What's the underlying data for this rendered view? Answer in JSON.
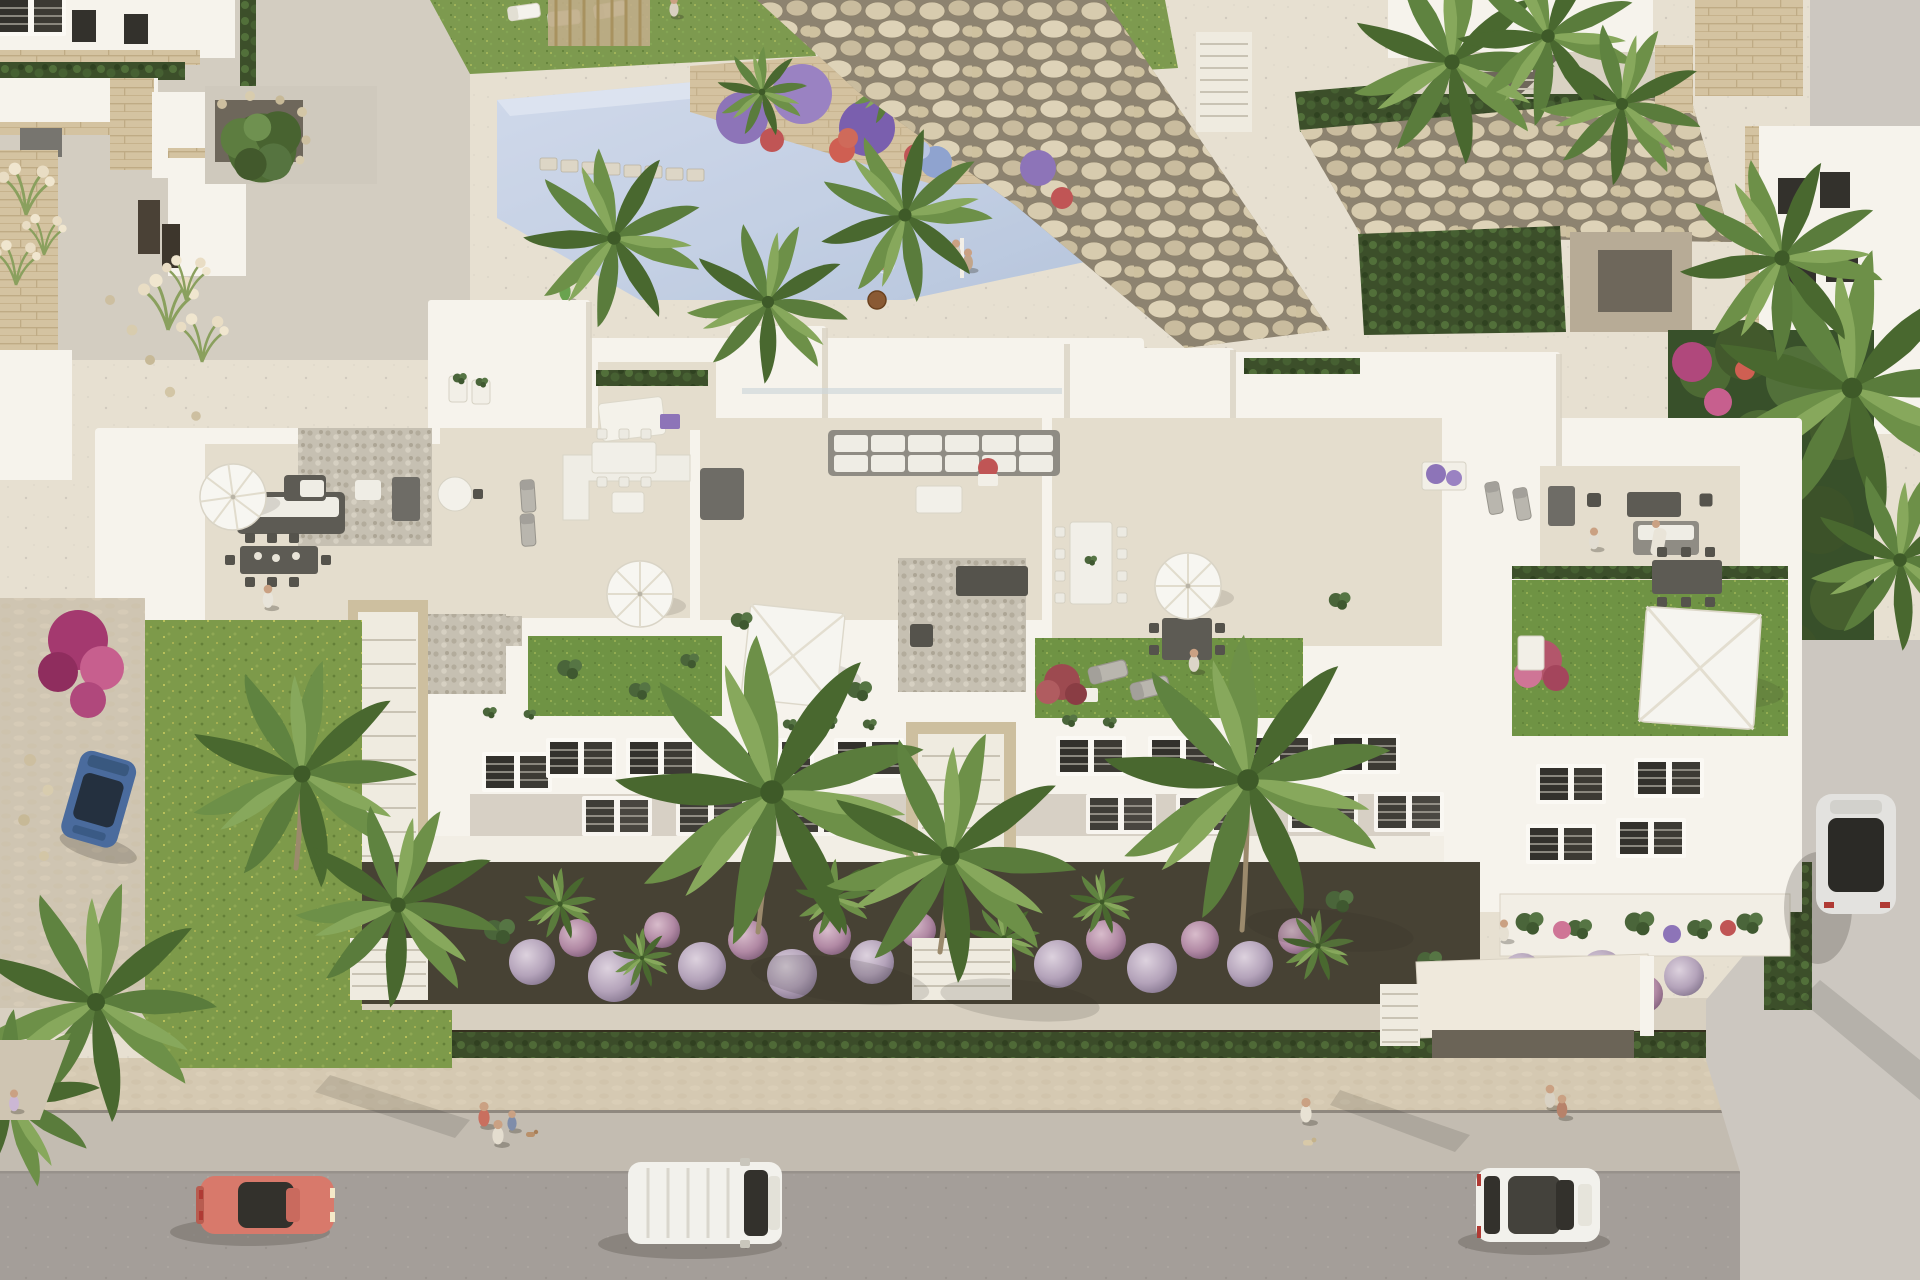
{
  "meta": {
    "title": "Aerial 3D render - white Mediterranean apartment complex with roof terraces, pool and street",
    "camera": "top-down oblique aerial view",
    "lighting": "warm late-afternoon sun, soft shadows falling to the lower-right",
    "style": "photorealistic architectural visualization"
  },
  "palette": {
    "plaza": "#e7e0d1",
    "terrace_floor": "#e4ddcd",
    "roof_wall": "#f6f3ec",
    "lawn_roof": "#6f9344",
    "lawn_wild": "#7d9a4a",
    "pool_water": "#c6d1e4",
    "soil": "#474234",
    "walkway": "#d8d0c1",
    "sidewalk": "#d5c9b2",
    "gutter": "#c3bcb1",
    "street": "#a49e99",
    "driveway": "#ccc7c0",
    "boulder_gap": "#8d8370",
    "stone_trim": "#d2c1a0",
    "hedge_dark": "#3c4f2a",
    "tree_green": "#4d6a34",
    "palm_green": "#5a7c3c",
    "umbrella_white": "#f7f6f1",
    "furniture_dark": "#5d5b54",
    "cushion_white": "#efede5",
    "flower_purple": "#8d74b8",
    "flower_pink": "#cf7596",
    "flower_red": "#c05555",
    "lavender_ball": "#c0afc4",
    "car_coral": "#d8796b",
    "car_blue": "#4a6b9d",
    "car_white": "#f2f1ec",
    "car_silver": "#e3e2df",
    "glass_dark": "#33312c",
    "skin": "#caa183"
  },
  "scene": {
    "setting": "Mediterranean residential complex seen from above",
    "areas": [
      "communal pool with stepping stones and flower island",
      "boulder rock retaining walls",
      "six roof terraces with outdoor furniture",
      "two-storey white facades with louvered windows",
      "ground-floor gardens with palms and lavender balls",
      "perimeter stone wall with hedge",
      "sidewalk and asphalt street with cars",
      "right-hand driveway",
      "neighbouring villas top-left and top-right"
    ],
    "pool": {
      "people_in_or_near": 4,
      "features": [
        "stepping stones",
        "planter island with purple and red flowers",
        "outdoor shower",
        "palm overhang"
      ]
    },
    "terraces": {
      "count": 6,
      "furniture": [
        "white parasols",
        "square shade sails",
        "corner sofas",
        "dining tables",
        "sun loungers",
        "day bed",
        "barbecue blocks",
        "gravel patches",
        "lawn patches"
      ]
    },
    "vehicles": [
      {
        "type": "coupe",
        "color_name": "coral red",
        "hex": "#d8796b",
        "location": "street bottom-left"
      },
      {
        "type": "panel van",
        "color_name": "white",
        "hex": "#f2f1ec",
        "location": "street centre"
      },
      {
        "type": "hatchback",
        "color_name": "white",
        "hex": "#f2f1ec",
        "location": "street bottom-right"
      },
      {
        "type": "estate car",
        "color_name": "dark blue",
        "hex": "#4a6b9d",
        "location": "left lane beside garden"
      },
      {
        "type": "car with panoramic roof",
        "color_name": "silver white",
        "hex": "#e3e2df",
        "location": "right driveway"
      }
    ],
    "people_count": 15,
    "dogs_count": 2
  }
}
